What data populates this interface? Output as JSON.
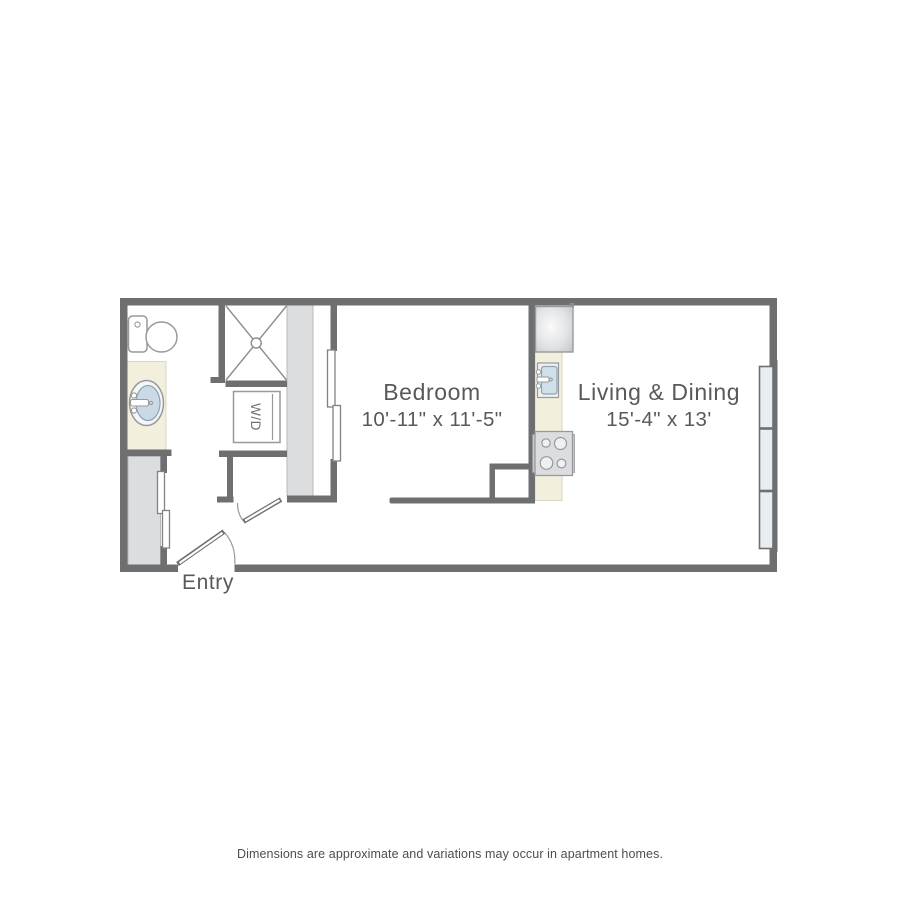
{
  "floorplan": {
    "rooms": {
      "bedroom": {
        "name": "Bedroom",
        "dimensions": "10'-11\" x 11'-5\""
      },
      "living_dining": {
        "name": "Living & Dining",
        "dimensions": "15'-4\" x 13'"
      },
      "entry": {
        "name": "Entry"
      },
      "laundry": {
        "label": "W/D"
      }
    },
    "colors": {
      "wall": "#6e6f71",
      "closet_fill": "#dcddde",
      "counter_fill": "#f2efdd",
      "window_fill": "#e9eef2",
      "fixture_stroke": "#97999c",
      "label_text": "#58595b"
    }
  },
  "footer": {
    "disclaimer": "Dimensions are approximate and variations may occur in apartment homes."
  }
}
